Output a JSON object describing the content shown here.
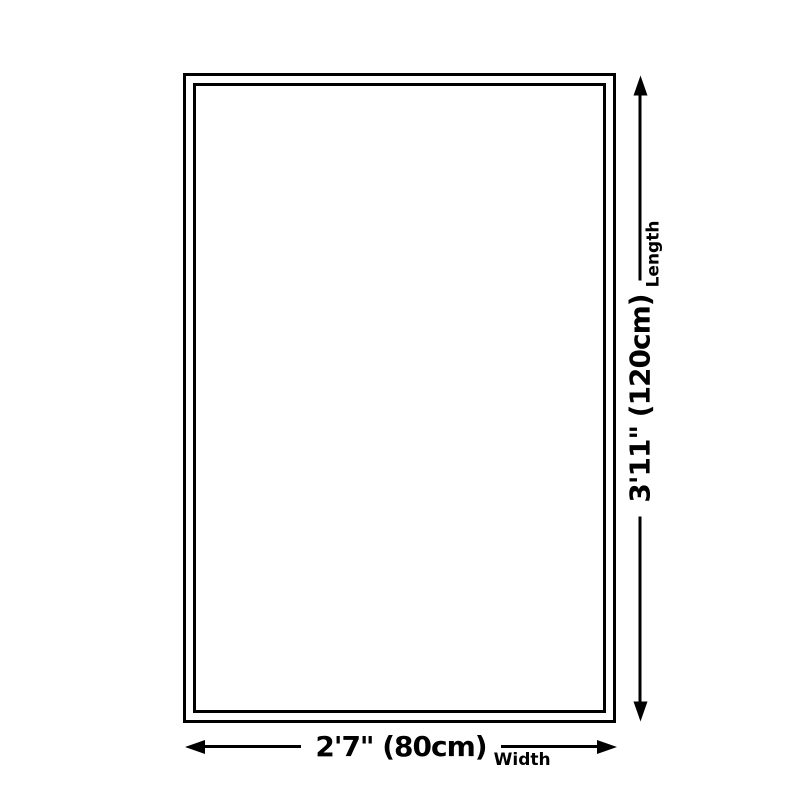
{
  "colors": {
    "background": "#ffffff",
    "line": "#000000"
  },
  "diagram": {
    "length_dimension": {
      "value": "3'11\" (120cm)",
      "label": "Length"
    },
    "width_dimension": {
      "value": "2'7\" (80cm)",
      "label": "Width"
    }
  }
}
